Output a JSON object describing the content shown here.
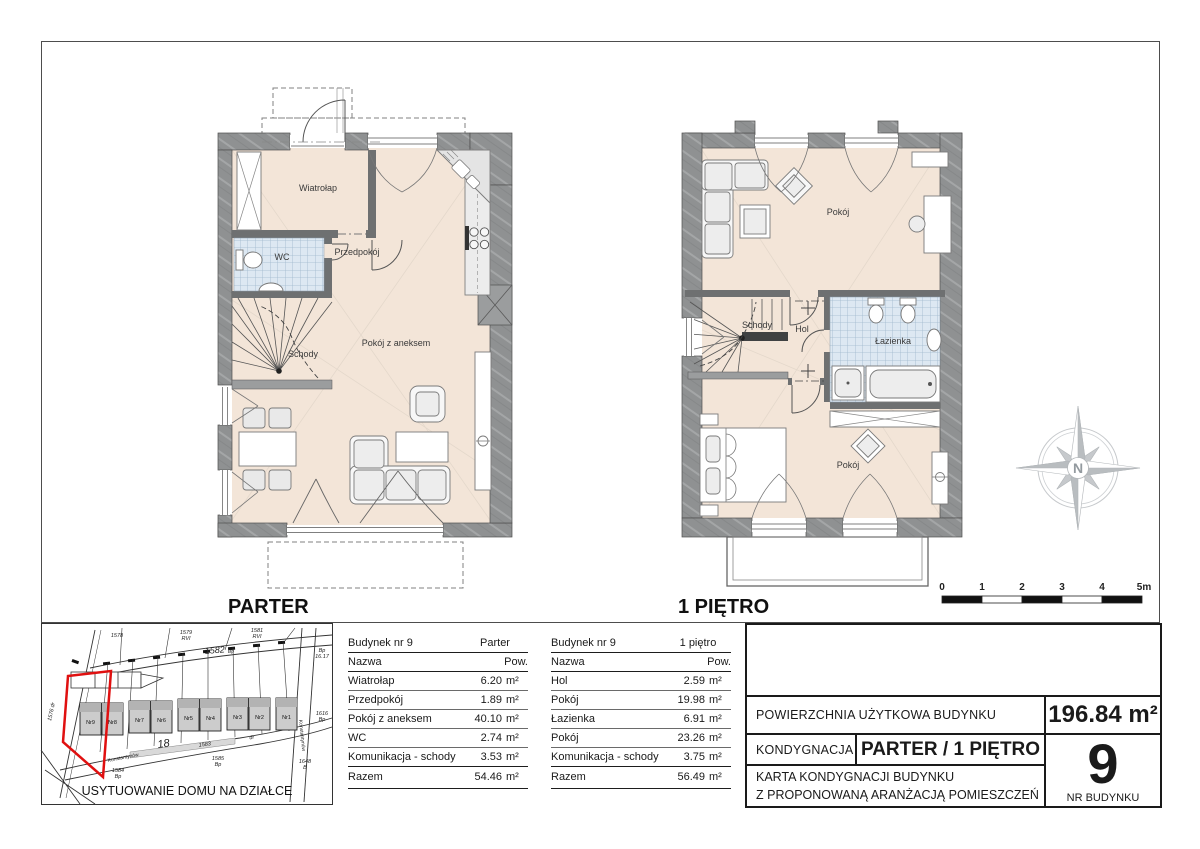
{
  "plans": {
    "parter": {
      "caption": "PARTER",
      "rooms": {
        "wiatrolap": "Wiatrołap",
        "wc": "WC",
        "przedpokoj": "Przedpokój",
        "schody": "Schody",
        "pokoj_z_aneksem": "Pokój z aneksem"
      }
    },
    "pietro": {
      "caption": "1 PIĘTRO",
      "rooms": {
        "pokoj_gorny": "Pokój",
        "schody": "Schody",
        "hol": "Hol",
        "lazienka": "Łazienka",
        "pokoj_dolny": "Pokój"
      }
    }
  },
  "compass": {
    "letter": "N"
  },
  "scale_bar": {
    "ticks": [
      "0",
      "1",
      "2",
      "3",
      "4",
      "5m"
    ]
  },
  "site_plan": {
    "caption": "USYTUOWANIE DOMU NA DZIAŁCE",
    "highlight_color": "#e01010",
    "houses": [
      "Nr9",
      "Nr8",
      "Nr7",
      "Nr6",
      "Nr5",
      "Nr4",
      "Nr3",
      "Nr2",
      "Nr1"
    ],
    "labels": {
      "a1578": "1578",
      "a1579": "1579",
      "a1579c": "RVI",
      "a1581": "1581",
      "a1581c": "RVI",
      "road": "1582",
      "roadc": "Bp",
      "b1617a": "Bp",
      "b1617": "16.17",
      "a1616": "1616",
      "a1616c": "Bp",
      "a1648": "1648",
      "a1648c": "B",
      "a1585": "1585",
      "a1585c": "Bp",
      "a1584": "1584",
      "a1584c": "Bp",
      "a1583": "1583",
      "adr": "dr",
      "a18": "18",
      "a1576": "1576 dr",
      "street1": "Konstantynów",
      "street2": "Konstantynów"
    }
  },
  "tables": [
    {
      "building": "Budynek nr 9",
      "floor": "Parter",
      "name_header": "Nazwa",
      "area_header": "Pow.",
      "unit": "m²",
      "rows": [
        {
          "name": "Wiatrołap",
          "area": "6.20"
        },
        {
          "name": "Przedpokój",
          "area": "1.89"
        },
        {
          "name": "Pokój z aneksem",
          "area": "40.10"
        },
        {
          "name": "WC",
          "area": "2.74"
        },
        {
          "name": "Komunikacja - schody",
          "area": "3.53"
        }
      ],
      "total_label": "Razem",
      "total_area": "54.46"
    },
    {
      "building": "Budynek nr 9",
      "floor": "1 piętro",
      "name_header": "Nazwa",
      "area_header": "Pow.",
      "unit": "m²",
      "rows": [
        {
          "name": "Hol",
          "area": "2.59"
        },
        {
          "name": "Pokój",
          "area": "19.98"
        },
        {
          "name": "Łazienka",
          "area": "6.91"
        },
        {
          "name": "Pokój",
          "area": "23.26"
        },
        {
          "name": "Komunikacja - schody",
          "area": "3.75"
        }
      ],
      "total_label": "Razem",
      "total_area": "56.49"
    }
  ],
  "title_block": {
    "usable_area_label": "POWIERZCHNIA UŻYTKOWA BUDYNKU",
    "usable_area_value": "196.84 m²",
    "storey_label": "KONDYGNACJA",
    "storey_value": "PARTER / 1 PIĘTRO",
    "card_title_line1": "KARTA KONDYGNACJI BUDYNKU",
    "card_title_line2": "Z PROPONOWANĄ ARANŻACJĄ POMIESZCZEŃ",
    "building_number": "9",
    "building_number_label": "NR BUDYNKU"
  }
}
